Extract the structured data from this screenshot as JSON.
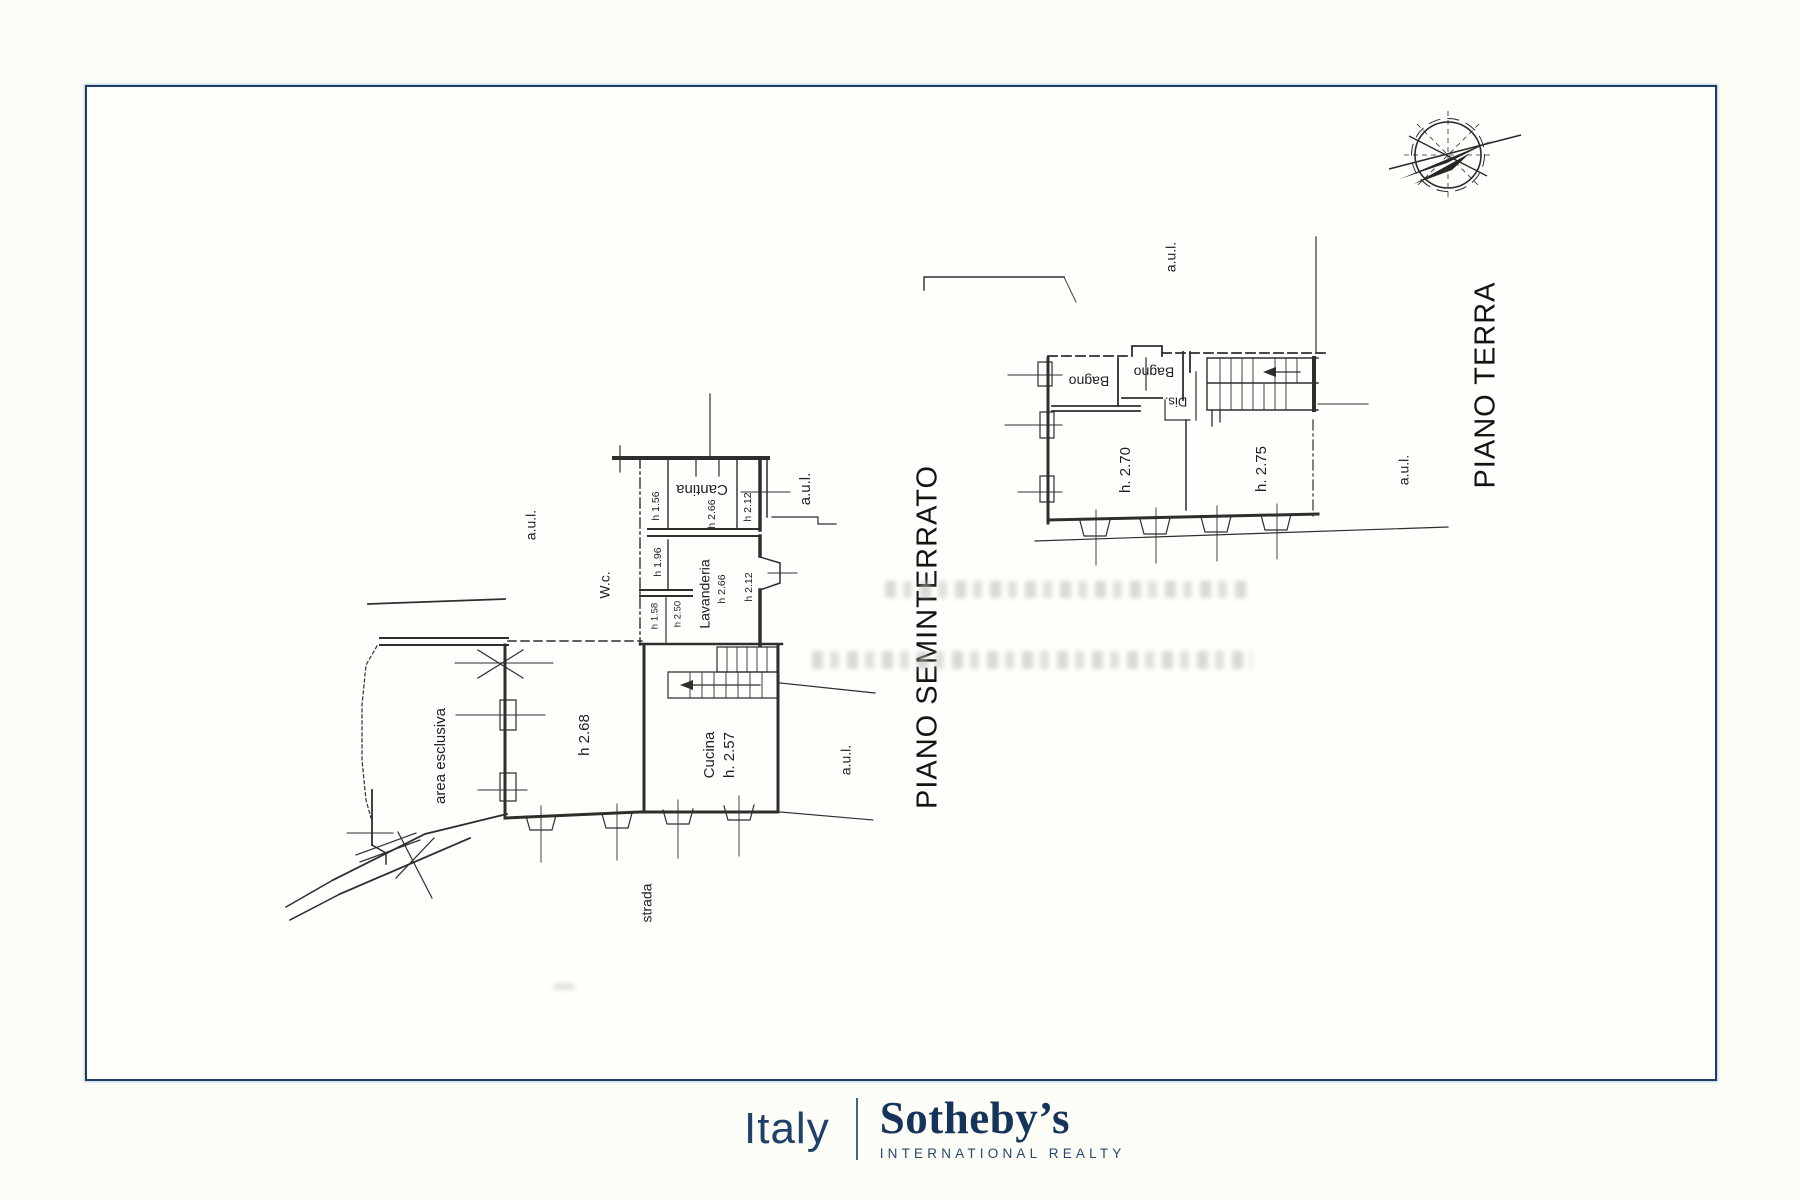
{
  "sheet": {
    "background": "#fdfdf8",
    "border_color": "#1f3c63"
  },
  "compass": {
    "icon": "compass-rose"
  },
  "plans": {
    "seminterrato": {
      "title": "PIANO SEMINTERRATO",
      "labels": [
        {
          "id": "title-seminterrato",
          "text": "PIANO SEMINTERRATO",
          "x": 929,
          "y": 637,
          "rot": -90,
          "size": 29
        },
        {
          "id": "room-cantina",
          "text": "Cantina",
          "x": 702,
          "y": 489,
          "rot": 180,
          "size": 15
        },
        {
          "id": "height-cantina-left",
          "text": "h 1.56",
          "x": 656,
          "y": 506,
          "rot": -90,
          "size": 10.5
        },
        {
          "id": "height-cantina",
          "text": "h 2.66",
          "x": 712,
          "y": 514,
          "rot": -90,
          "size": 10.5
        },
        {
          "id": "height-right-upper",
          "text": "h 2.12",
          "x": 748,
          "y": 507,
          "rot": -90,
          "size": 10.5
        },
        {
          "id": "aul-wing",
          "text": "a.u.l.",
          "x": 806,
          "y": 489,
          "rot": -90,
          "size": 15
        },
        {
          "id": "room-wc",
          "text": "W.c.",
          "x": 606,
          "y": 585,
          "rot": -90,
          "size": 14
        },
        {
          "id": "height-196",
          "text": "h 1.96",
          "x": 658,
          "y": 562,
          "rot": -90,
          "size": 10.5
        },
        {
          "id": "room-lavanderia",
          "text": "Lavanderia",
          "x": 706,
          "y": 594,
          "rot": -90,
          "size": 14
        },
        {
          "id": "height-lavanderia",
          "text": "h 2.66",
          "x": 722,
          "y": 589,
          "rot": -90,
          "size": 10.5
        },
        {
          "id": "height-right-lower",
          "text": "h 2.12",
          "x": 749,
          "y": 587,
          "rot": -90,
          "size": 10.5
        },
        {
          "id": "height-158",
          "text": "h 1.58",
          "x": 655,
          "y": 616,
          "rot": -90,
          "size": 9.5
        },
        {
          "id": "height-250",
          "text": "h 2.50",
          "x": 678,
          "y": 614,
          "rot": -90,
          "size": 9.5
        },
        {
          "id": "aul-left",
          "text": "a.u.l.",
          "x": 532,
          "y": 525,
          "rot": -90,
          "size": 14
        },
        {
          "id": "area-esclusiva",
          "text": "area esclusiva",
          "x": 441,
          "y": 756,
          "rot": -90,
          "size": 15
        },
        {
          "id": "height-268",
          "text": "h 2.68",
          "x": 585,
          "y": 735,
          "rot": -90,
          "size": 15
        },
        {
          "id": "room-cucina",
          "text": "Cucina",
          "x": 710,
          "y": 755,
          "rot": -90,
          "size": 15
        },
        {
          "id": "height-cucina",
          "text": "h. 2.57",
          "x": 730,
          "y": 755,
          "rot": -90,
          "size": 15
        },
        {
          "id": "aul-right",
          "text": "a.u.l.",
          "x": 847,
          "y": 760,
          "rot": -90,
          "size": 14
        },
        {
          "id": "strada",
          "text": "strada",
          "x": 648,
          "y": 903,
          "rot": -90,
          "size": 14
        }
      ]
    },
    "terra": {
      "title": "PIANO TERRA",
      "labels": [
        {
          "id": "title-terra",
          "text": "PIANO TERRA",
          "x": 1487,
          "y": 385,
          "rot": -90,
          "size": 29
        },
        {
          "id": "aul-top",
          "text": "a.u.l.",
          "x": 1172,
          "y": 257,
          "rot": -90,
          "size": 14
        },
        {
          "id": "room-bagno-1",
          "text": "Bagno",
          "x": 1089,
          "y": 380,
          "rot": 180,
          "size": 14
        },
        {
          "id": "room-bagno-2",
          "text": "Bagno",
          "x": 1154,
          "y": 371,
          "rot": 180,
          "size": 14
        },
        {
          "id": "room-dis",
          "text": "Dis.",
          "x": 1176,
          "y": 401,
          "rot": 180,
          "size": 13
        },
        {
          "id": "height-270",
          "text": "h. 2.70",
          "x": 1126,
          "y": 470,
          "rot": -90,
          "size": 15
        },
        {
          "id": "height-275",
          "text": "h. 2.75",
          "x": 1262,
          "y": 469,
          "rot": -90,
          "size": 15
        },
        {
          "id": "aul-terra-right",
          "text": "a.u.l.",
          "x": 1405,
          "y": 470,
          "rot": -90,
          "size": 14
        }
      ]
    }
  },
  "footer_logo": {
    "country": "Italy",
    "brand": "Sotheby’s",
    "tagline": "INTERNATIONAL REALTY",
    "color": "#16335a"
  }
}
